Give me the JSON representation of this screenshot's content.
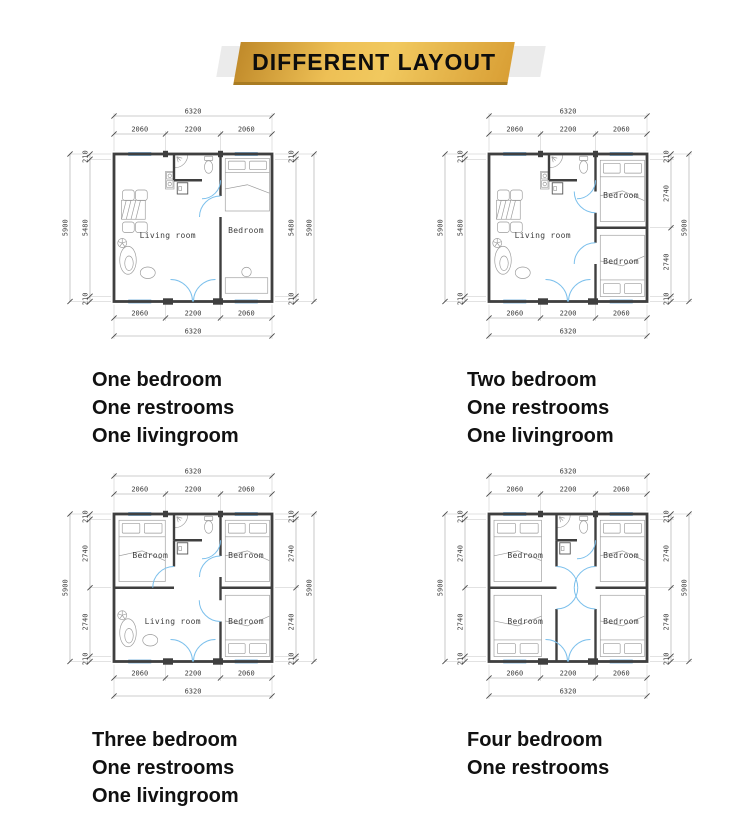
{
  "banner": {
    "label": "DIFFERENT LAYOUT"
  },
  "colors": {
    "banner_gold_dark": "#c08a2a",
    "banner_gold_light": "#f1c95f",
    "banner_band_gray": "#ebebeb",
    "wall": "#3f3f3f",
    "window_fill": "#b8dbf4",
    "window_edge": "#5a9ed2",
    "door_blue": "#7cc0ec",
    "dim_line": "#9a9a9a",
    "dim_text": "#3b3b3b",
    "furniture": "#9a9a9a",
    "caption_text": "#111111"
  },
  "plans": [
    {
      "layout": "1br",
      "caption_lines": [
        "One bedroom",
        "One restrooms",
        "One livingroom"
      ],
      "dims": {
        "top_total": "6320",
        "top_segments": [
          "2060",
          "2200",
          "2060"
        ],
        "bottom_segments": [
          "2060",
          "2200",
          "2060"
        ],
        "bottom_total": "6320",
        "left_outer": "5900",
        "left_chain": [
          "210",
          "5480",
          "210"
        ],
        "right_chain": [
          "210",
          "5480",
          "210"
        ],
        "right_outer": "5900"
      },
      "rooms": [
        {
          "label": "Living room",
          "x": 2150,
          "y": 3350
        },
        {
          "label": "Bedroom",
          "x": 5280,
          "y": 3150
        }
      ]
    },
    {
      "layout": "2br",
      "caption_lines": [
        "Two bedroom",
        "One restrooms",
        "One livingroom"
      ],
      "dims": {
        "top_total": "6320",
        "top_segments": [
          "2060",
          "2200",
          "2060"
        ],
        "bottom_segments": [
          "2060",
          "2200",
          "2060"
        ],
        "bottom_total": "6320",
        "left_outer": "5900",
        "left_chain": [
          "210",
          "5480",
          "210"
        ],
        "right_chain": [
          "210",
          "2740",
          "2740",
          "210"
        ],
        "right_outer": "5900"
      },
      "rooms": [
        {
          "label": "Living room",
          "x": 2150,
          "y": 3350
        },
        {
          "label": "Bedroom",
          "x": 5280,
          "y": 1750
        },
        {
          "label": "Bedroom",
          "x": 5280,
          "y": 4400
        }
      ]
    },
    {
      "layout": "3br",
      "caption_lines": [
        "Three bedroom",
        "One restrooms",
        "One livingroom"
      ],
      "dims": {
        "top_total": "6320",
        "top_segments": [
          "2060",
          "2200",
          "2060"
        ],
        "bottom_segments": [
          "2060",
          "2200",
          "2060"
        ],
        "bottom_total": "6320",
        "left_outer": "5900",
        "left_chain": [
          "210",
          "2740",
          "2740",
          "210"
        ],
        "right_chain": [
          "210",
          "2740",
          "2740",
          "210"
        ],
        "right_outer": "5900"
      },
      "rooms": [
        {
          "label": "Bedroom",
          "x": 1450,
          "y": 1750
        },
        {
          "label": "Bedroom",
          "x": 5280,
          "y": 1750
        },
        {
          "label": "Living room",
          "x": 2350,
          "y": 4400
        },
        {
          "label": "Bedroom",
          "x": 5280,
          "y": 4400
        }
      ]
    },
    {
      "layout": "4br",
      "caption_lines": [
        "Four bedroom",
        "One restrooms"
      ],
      "dims": {
        "top_total": "6320",
        "top_segments": [
          "2060",
          "2200",
          "2060"
        ],
        "bottom_segments": [
          "2060",
          "2200",
          "2060"
        ],
        "bottom_total": "6320",
        "left_outer": "5900",
        "left_chain": [
          "210",
          "2740",
          "2740",
          "210"
        ],
        "right_chain": [
          "210",
          "2740",
          "2740",
          "210"
        ],
        "right_outer": "5900"
      },
      "rooms": [
        {
          "label": "Bedroom",
          "x": 1450,
          "y": 1750
        },
        {
          "label": "Bedroom",
          "x": 5280,
          "y": 1750
        },
        {
          "label": "Bedroom",
          "x": 1450,
          "y": 4400
        },
        {
          "label": "Bedroom",
          "x": 5280,
          "y": 4400
        }
      ]
    }
  ]
}
